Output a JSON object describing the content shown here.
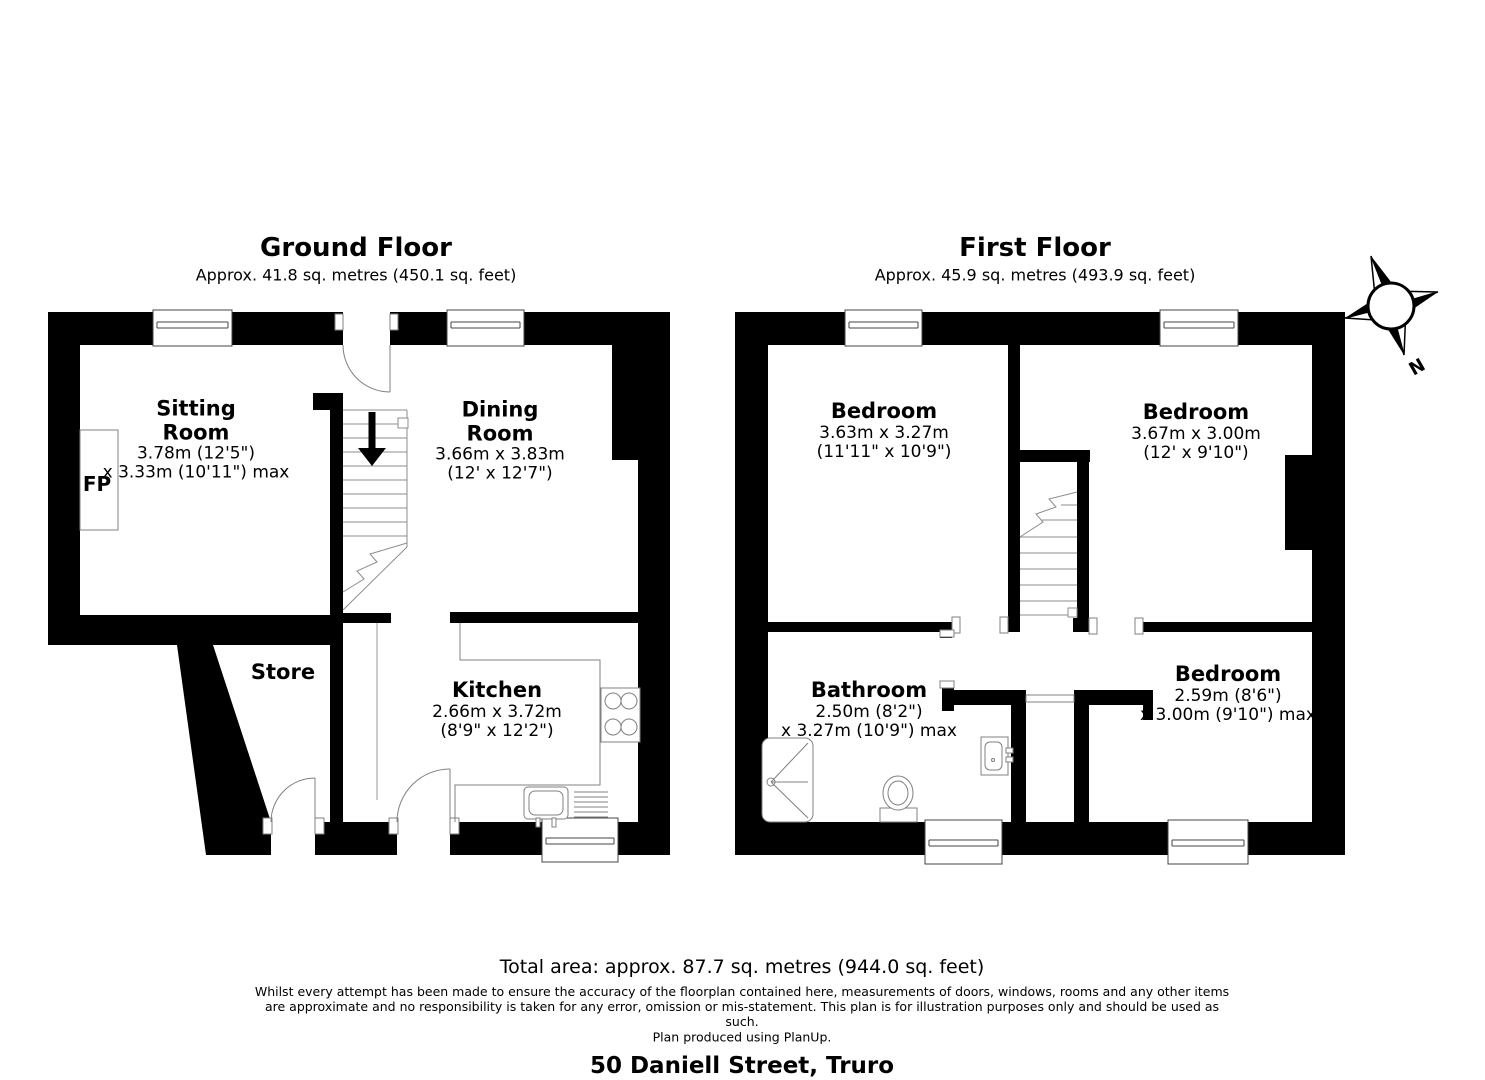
{
  "ground_floor": {
    "title": "Ground Floor",
    "subtitle": "Approx. 41.8 sq. metres (450.1 sq. feet)",
    "rooms": {
      "sitting": {
        "lines": [
          "Sitting",
          "Room",
          "3.78m (12'5\")",
          "x 3.33m (10'11\") max"
        ]
      },
      "dining": {
        "lines": [
          "Dining",
          "Room",
          "3.66m x 3.83m",
          "(12' x 12'7\")"
        ]
      },
      "store": {
        "lines": [
          "Store"
        ]
      },
      "kitchen": {
        "lines": [
          "Kitchen",
          "2.66m x 3.72m",
          "(8'9\" x 12'2\")"
        ]
      },
      "fireplace": "FP"
    }
  },
  "first_floor": {
    "title": "First Floor",
    "subtitle": "Approx. 45.9 sq. metres (493.9 sq. feet)",
    "rooms": {
      "bedroom1": {
        "lines": [
          "Bedroom",
          "3.63m x 3.27m",
          "(11'11\" x 10'9\")"
        ]
      },
      "bedroom2": {
        "lines": [
          "Bedroom",
          "3.67m x 3.00m",
          "(12' x 9'10\")"
        ]
      },
      "bathroom": {
        "lines": [
          "Bathroom",
          "2.50m (8'2\")",
          "x 3.27m (10'9\") max"
        ]
      },
      "bedroom3": {
        "lines": [
          "Bedroom",
          "2.59m (8'6\")",
          "x 3.00m (9'10\") max"
        ]
      }
    }
  },
  "compass": {
    "north_label": "N"
  },
  "footer": {
    "total_area": "Total area: approx. 87.7 sq. metres (944.0 sq. feet)",
    "disclaimer": "Whilst every attempt has been made to ensure the accuracy of the floorplan contained here, measurements of doors, windows, rooms and any other items are approximate and no responsibility is taken for any error, omission or mis-statement. This plan is for illustration purposes only and should be used as such.",
    "produced_by": "Plan produced using PlanUp.",
    "address": "50 Daniell Street, Truro"
  },
  "colors": {
    "wall": "#000000",
    "fixture_line": "#808080",
    "background": "#ffffff"
  }
}
